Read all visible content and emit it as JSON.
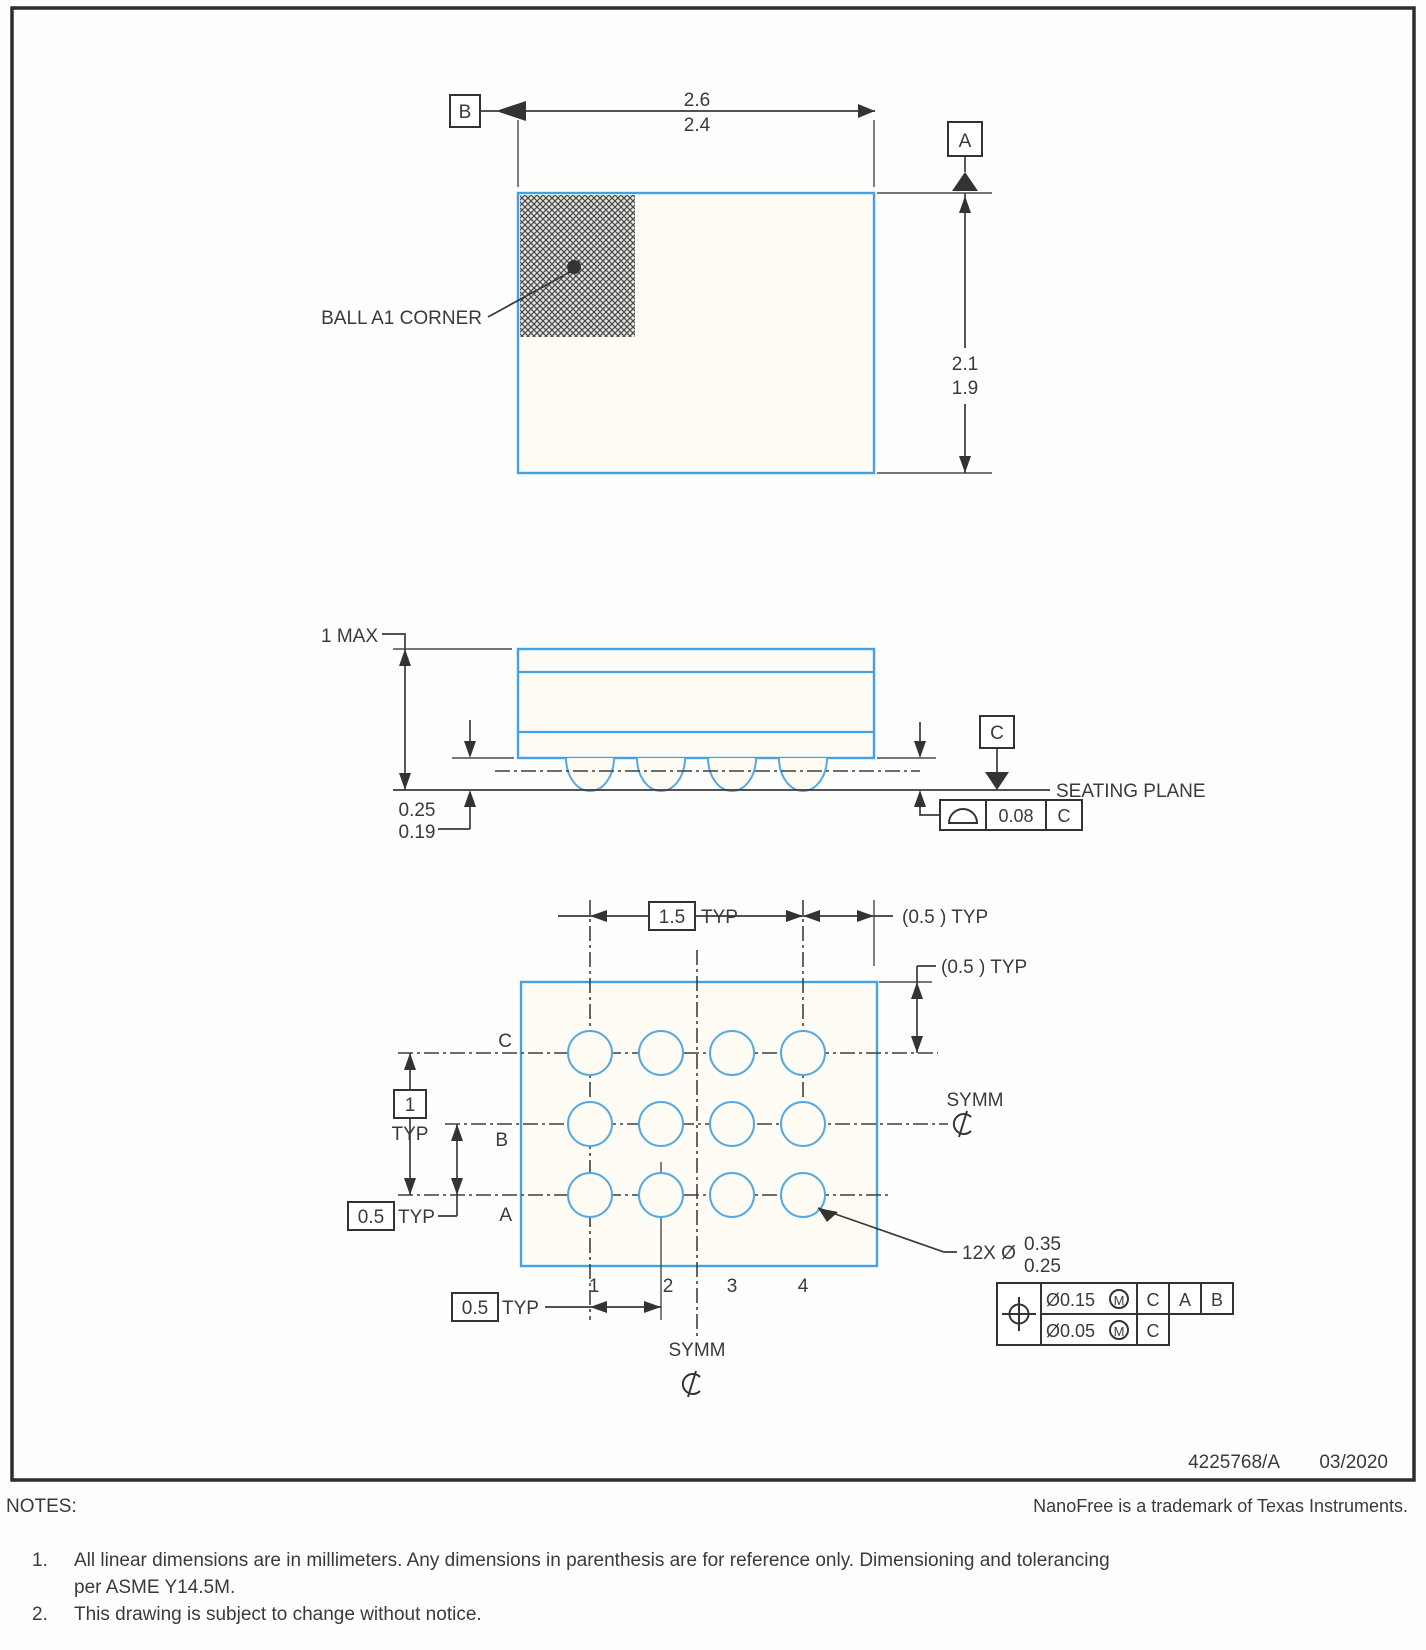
{
  "colors": {
    "package_outline": "#44a1e4",
    "drawing_line": "#333333"
  },
  "top_view": {
    "datum_b": "B",
    "datum_a": "A",
    "width_upper": "2.6",
    "width_lower": "2.4",
    "height_upper": "2.1",
    "height_lower": "1.9",
    "ball_a1_label": "BALL A1 CORNER"
  },
  "side_view": {
    "max_height": "1 MAX",
    "ball_h_upper": "0.25",
    "ball_h_lower": "0.19",
    "datum_c": "C",
    "seating_plane": "SEATING PLANE",
    "flatness_tol": "0.08",
    "flatness_datum": "C"
  },
  "bottom_view": {
    "pitch_span": "1.5",
    "typ": "TYP",
    "col_ref_typ": "(0.5 ) TYP",
    "row_ref_typ": "(0.5 ) TYP",
    "row_span": "1",
    "row_pitch": "0.5",
    "col_pitch": "0.5",
    "symm": "SYMM",
    "rows": [
      "C",
      "B",
      "A"
    ],
    "cols": [
      "1",
      "2",
      "3",
      "4"
    ],
    "ball_callout": "12X Ø",
    "ball_dia_upper": "0.35",
    "ball_dia_lower": "0.25",
    "fcf": {
      "tol1": "Ø0.15",
      "mod": "M",
      "d1": "C",
      "d2": "A",
      "d3": "B",
      "tol2": "Ø0.05",
      "d4": "C"
    }
  },
  "footer": {
    "doc_number": "4225768/A",
    "date": "03/2020",
    "notes_title": "NOTES:",
    "trademark": "NanoFree is a trademark of Texas Instruments.",
    "note1_num": "1.",
    "note1_line1": "All linear dimensions are in millimeters. Any dimensions in parenthesis are for reference only. Dimensioning and tolerancing",
    "note1_line2": "per ASME Y14.5M.",
    "note2_num": "2.",
    "note2_text": "This drawing is subject to change without notice."
  }
}
